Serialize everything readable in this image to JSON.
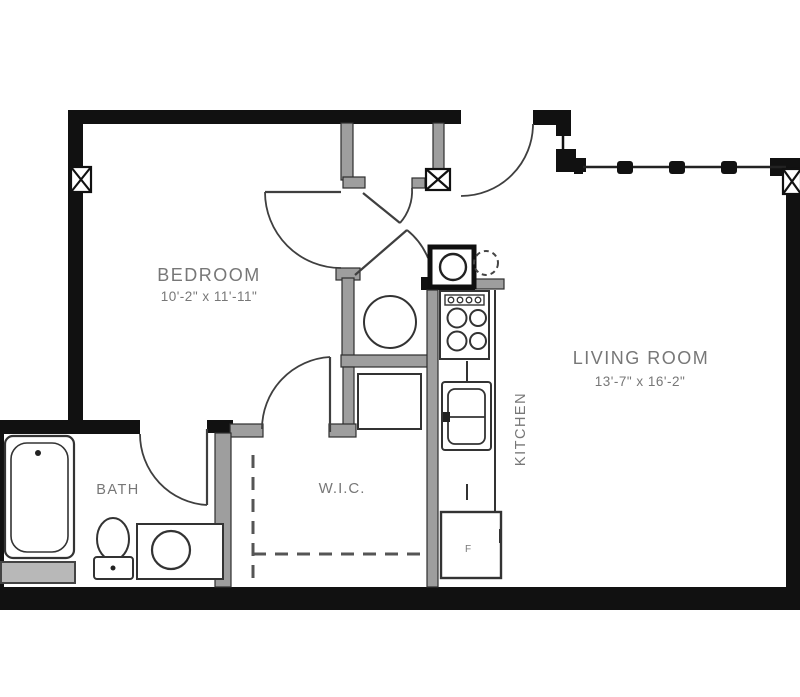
{
  "title": "Apartment unit floor plan",
  "rooms": {
    "bedroom": {
      "label": "BEDROOM",
      "dims": "10'-2\" x 11'-11\""
    },
    "living": {
      "label": "LIVING ROOM",
      "dims": "13'-7\" x 16'-2\""
    },
    "bath": {
      "label": "BATH"
    },
    "wic": {
      "label": "W.I.C."
    },
    "kitchen": {
      "label": "KITCHEN"
    }
  },
  "appliances": {
    "refrigerator_label": "F"
  },
  "colors": {
    "exterior_wall": "#111111",
    "interior_wall": "#9e9e9e",
    "fixture_line": "#333333",
    "label_text": "#777777",
    "background": "#ffffff"
  }
}
